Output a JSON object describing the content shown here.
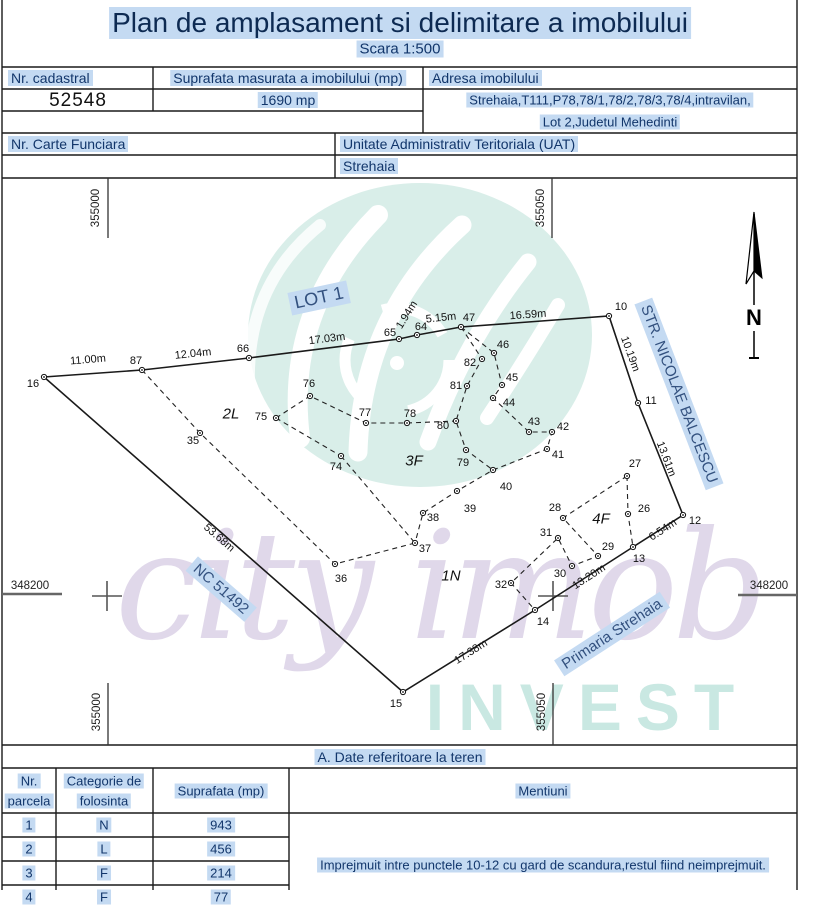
{
  "page": {
    "title": "Plan de amplasament si delimitare a imobilului",
    "scale": "Scara 1:500"
  },
  "header_table": {
    "nr_cadastral_label": "Nr. cadastral",
    "nr_cadastral_value": "52548",
    "suprafata_label": "Suprafata masurata a imobilului (mp)",
    "suprafata_value": "1690 mp",
    "adresa_label": "Adresa imobilului",
    "adresa_line1": "Strehaia,T111,P78,78/1,78/2,78/3,78/4,intravilan,",
    "adresa_line2": "Lot 2,Judetul Mehedinti",
    "carte_funciara_label": "Nr. Carte Funciara",
    "uat_label": "Unitate Administrativ Teritoriala (UAT)",
    "uat_value": "Strehaia"
  },
  "map": {
    "north_label": "N",
    "points": [
      {
        "n": "16",
        "x": 44,
        "y": 377,
        "lx": 33,
        "ly": 384
      },
      {
        "n": "87",
        "x": 142,
        "y": 370,
        "lx": 136,
        "ly": 361
      },
      {
        "n": "66",
        "x": 249,
        "y": 358,
        "lx": 243,
        "ly": 349
      },
      {
        "n": "65",
        "x": 399,
        "y": 339,
        "lx": 390,
        "ly": 333
      },
      {
        "n": "64",
        "x": 417,
        "y": 335,
        "lx": 421,
        "ly": 327
      },
      {
        "n": "47",
        "x": 461,
        "y": 327,
        "lx": 469,
        "ly": 318
      },
      {
        "n": "10",
        "x": 609,
        "y": 316,
        "lx": 621,
        "ly": 307
      },
      {
        "n": "11",
        "x": 638,
        "y": 403,
        "lx": 651,
        "ly": 401
      },
      {
        "n": "12",
        "x": 683,
        "y": 515,
        "lx": 695,
        "ly": 521
      },
      {
        "n": "13",
        "x": 633,
        "y": 547,
        "lx": 639,
        "ly": 559
      },
      {
        "n": "14",
        "x": 535,
        "y": 610,
        "lx": 543,
        "ly": 622
      },
      {
        "n": "15",
        "x": 403,
        "y": 692,
        "lx": 396,
        "ly": 704
      },
      {
        "n": "35",
        "x": 200,
        "y": 433,
        "lx": 193,
        "ly": 441
      },
      {
        "n": "36",
        "x": 335,
        "y": 564,
        "lx": 341,
        "ly": 579
      },
      {
        "n": "37",
        "x": 415,
        "y": 543,
        "lx": 425,
        "ly": 549
      },
      {
        "n": "38",
        "x": 423,
        "y": 513,
        "lx": 433,
        "ly": 518
      },
      {
        "n": "39",
        "x": 457,
        "y": 491,
        "lx": 470,
        "ly": 509
      },
      {
        "n": "40",
        "x": 493,
        "y": 470,
        "lx": 506,
        "ly": 487
      },
      {
        "n": "41",
        "x": 547,
        "y": 449,
        "lx": 558,
        "ly": 455
      },
      {
        "n": "42",
        "x": 552,
        "y": 432,
        "lx": 563,
        "ly": 427
      },
      {
        "n": "43",
        "x": 529,
        "y": 432,
        "lx": 534,
        "ly": 422
      },
      {
        "n": "44",
        "x": 493,
        "y": 398,
        "lx": 509,
        "ly": 403
      },
      {
        "n": "45",
        "x": 502,
        "y": 385,
        "lx": 512,
        "ly": 378
      },
      {
        "n": "46",
        "x": 494,
        "y": 353,
        "lx": 503,
        "ly": 345
      },
      {
        "n": "82",
        "x": 482,
        "y": 359,
        "lx": 470,
        "ly": 363
      },
      {
        "n": "81",
        "x": 467,
        "y": 386,
        "lx": 456,
        "ly": 386
      },
      {
        "n": "80",
        "x": 456,
        "y": 421,
        "lx": 443,
        "ly": 426
      },
      {
        "n": "79",
        "x": 466,
        "y": 450,
        "lx": 463,
        "ly": 463
      },
      {
        "n": "78",
        "x": 407,
        "y": 423,
        "lx": 410,
        "ly": 414
      },
      {
        "n": "77",
        "x": 366,
        "y": 423,
        "lx": 365,
        "ly": 413
      },
      {
        "n": "76",
        "x": 310,
        "y": 396,
        "lx": 309,
        "ly": 384
      },
      {
        "n": "75",
        "x": 276,
        "y": 418,
        "lx": 261,
        "ly": 417
      },
      {
        "n": "74",
        "x": 341,
        "y": 456,
        "lx": 336,
        "ly": 467
      },
      {
        "n": "27",
        "x": 627,
        "y": 476,
        "lx": 635,
        "ly": 464
      },
      {
        "n": "26",
        "x": 628,
        "y": 514,
        "lx": 644,
        "ly": 509
      },
      {
        "n": "28",
        "x": 563,
        "y": 518,
        "lx": 555,
        "ly": 508
      },
      {
        "n": "29",
        "x": 598,
        "y": 556,
        "lx": 608,
        "ly": 547
      },
      {
        "n": "30",
        "x": 572,
        "y": 566,
        "lx": 560,
        "ly": 574
      },
      {
        "n": "31",
        "x": 558,
        "y": 538,
        "lx": 546,
        "ly": 533
      },
      {
        "n": "32",
        "x": 511,
        "y": 583,
        "lx": 501,
        "ly": 585
      }
    ],
    "distances": [
      {
        "t": "11.00m",
        "x": 88,
        "y": 360,
        "r": -5
      },
      {
        "t": "12.04m",
        "x": 193,
        "y": 354,
        "r": -6
      },
      {
        "t": "17.03m",
        "x": 327,
        "y": 339,
        "r": -7
      },
      {
        "t": "1.94m",
        "x": 407,
        "y": 315,
        "r": -58
      },
      {
        "t": "5.15m",
        "x": 441,
        "y": 318,
        "r": -6
      },
      {
        "t": "16.59m",
        "x": 528,
        "y": 315,
        "r": -4
      },
      {
        "t": "10.19m",
        "x": 630,
        "y": 354,
        "r": 70
      },
      {
        "t": "13.61m",
        "x": 666,
        "y": 459,
        "r": 69
      },
      {
        "t": "6.54m",
        "x": 663,
        "y": 530,
        "r": -33
      },
      {
        "t": "13.20m",
        "x": 589,
        "y": 577,
        "r": -33
      },
      {
        "t": "17.38m",
        "x": 471,
        "y": 652,
        "r": -32
      },
      {
        "t": "53.68m",
        "x": 219,
        "y": 538,
        "r": 41
      }
    ],
    "regions": [
      {
        "t": "2L",
        "x": 231,
        "y": 414
      },
      {
        "t": "3F",
        "x": 414,
        "y": 461
      },
      {
        "t": "1N",
        "x": 451,
        "y": 576
      },
      {
        "t": "4F",
        "x": 601,
        "y": 519
      }
    ],
    "street_labels": [
      {
        "t": "LOT 1",
        "x": 319,
        "y": 298,
        "r": -12,
        "fs": 18
      },
      {
        "t": "NC 51492",
        "x": 221,
        "y": 589,
        "r": 41,
        "fs": 15
      },
      {
        "t": "STR. NICOLAE BALCESCU",
        "x": 679,
        "y": 394,
        "r": 69,
        "fs": 15
      },
      {
        "t": "Primaria Strehaia",
        "x": 612,
        "y": 634,
        "r": -33,
        "fs": 15
      }
    ],
    "grid_labels": [
      {
        "t": "355000",
        "x": 96,
        "y": 208,
        "r": -90
      },
      {
        "t": "355050",
        "x": 541,
        "y": 208,
        "r": -90
      },
      {
        "t": "348200",
        "x": 30,
        "y": 586,
        "r": 0
      },
      {
        "t": "348200",
        "x": 769,
        "y": 586,
        "r": 0
      },
      {
        "t": "355000",
        "x": 97,
        "y": 712,
        "r": -90
      },
      {
        "t": "355050",
        "x": 542,
        "y": 712,
        "r": -90
      }
    ]
  },
  "terrain_table": {
    "section_title": "A. Date referitoare la teren",
    "col1_line1": "Nr.",
    "col1_line2": "parcela",
    "col2_line1": "Categorie de",
    "col2_line2": "folosinta",
    "col3": "Suprafata (mp)",
    "col4": "Mentiuni",
    "rows": [
      [
        "1",
        "N",
        "943"
      ],
      [
        "2",
        "L",
        "456"
      ],
      [
        "3",
        "F",
        "214"
      ],
      [
        "4",
        "F",
        "77"
      ]
    ],
    "mentiuni_text": "Imprejmuit intre punctele 10-12 cu gard de scandura,restul fiind neimprejmuit."
  },
  "watermark": {
    "script": "city imob",
    "invest": "INVEST"
  },
  "colors": {
    "highlight": "#c4daf2",
    "navy": "#12366b",
    "logo_teal": "#d9eee9"
  }
}
